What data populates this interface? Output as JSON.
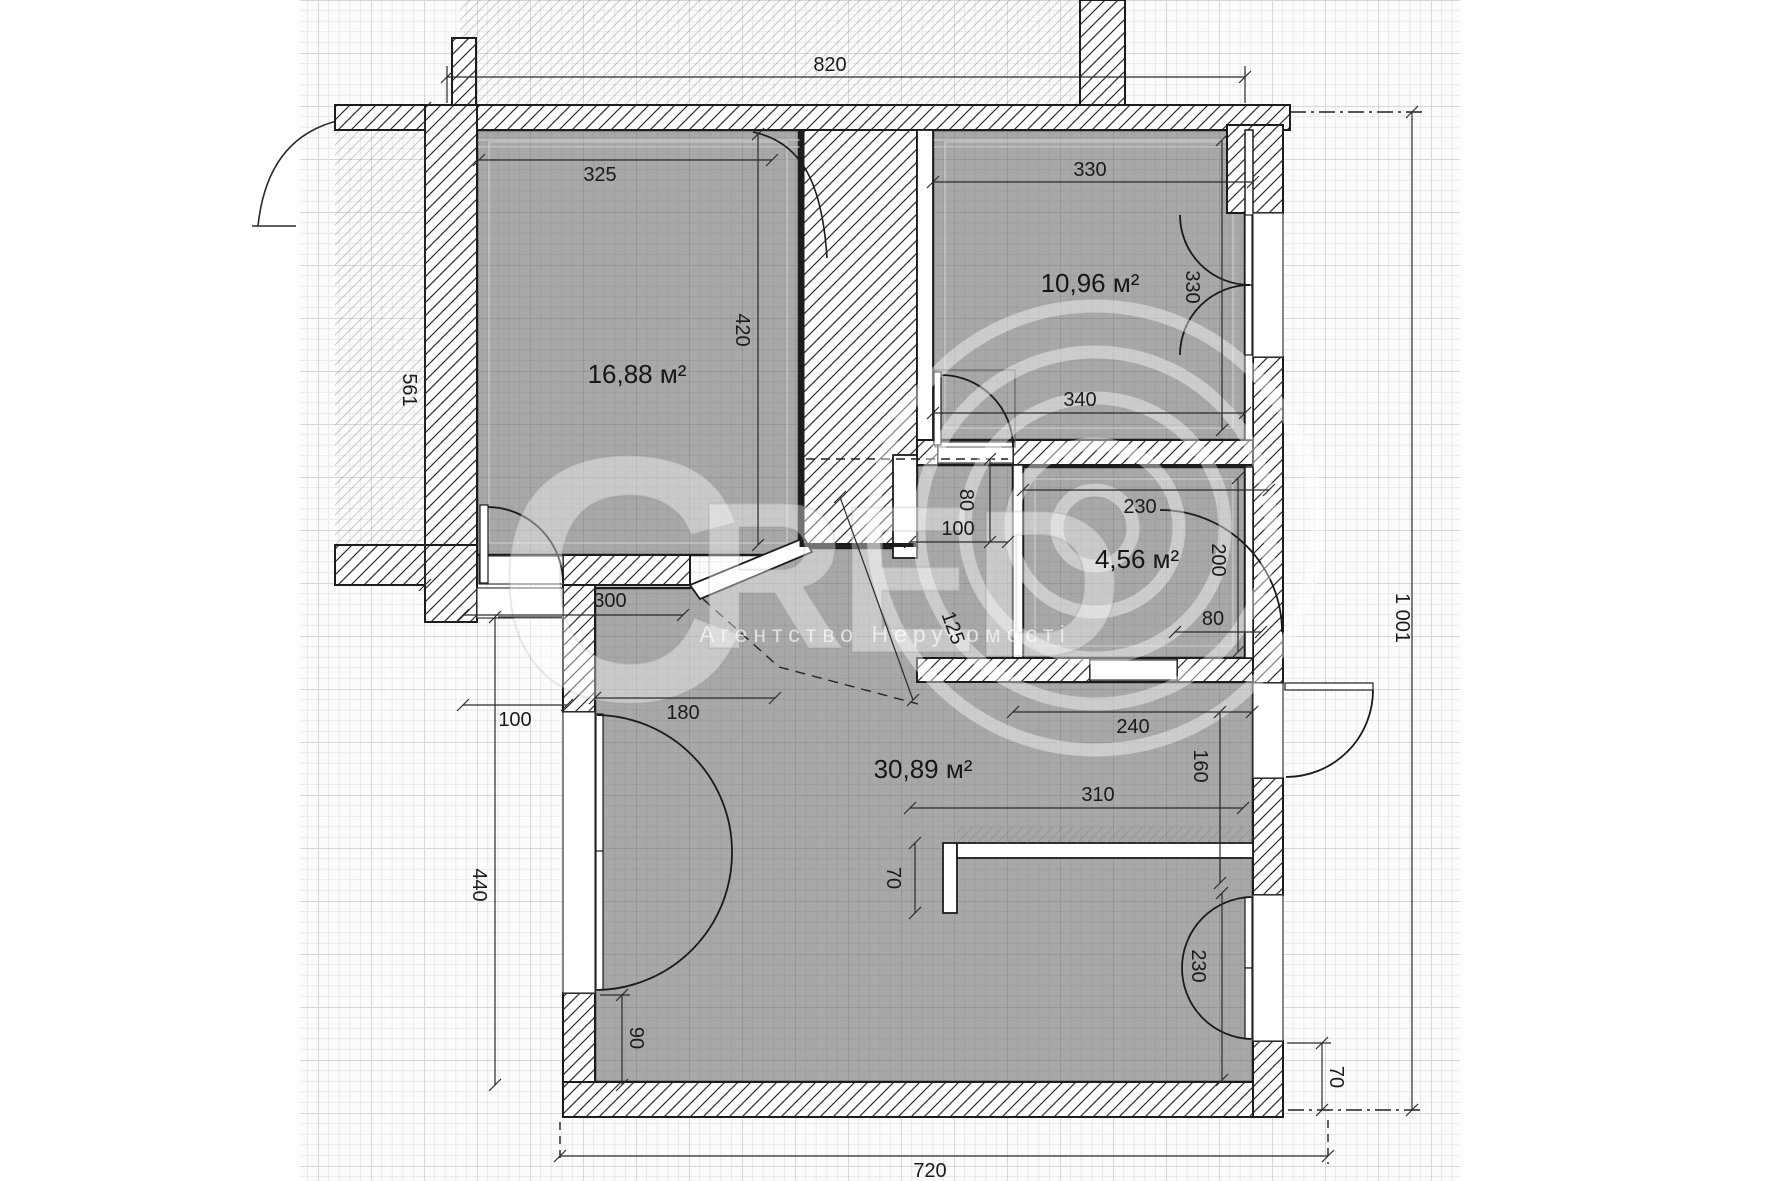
{
  "watermark": {
    "letters": [
      "C",
      "R",
      "E",
      "D"
    ],
    "subtitle": "Агентство Нерухомості"
  },
  "rooms": [
    {
      "id": "room-top-left",
      "area": "16,88 м²"
    },
    {
      "id": "room-top-right",
      "area": "10,96 м²"
    },
    {
      "id": "room-bathroom",
      "area": "4,56 м²"
    },
    {
      "id": "room-living",
      "area": "30,89 м²"
    }
  ],
  "dimensions": {
    "top_width": "820",
    "r1_top": "325",
    "r2_top": "330",
    "r2_door": "330",
    "r2_bottom": "340",
    "bath_top": "230",
    "bath_right": "200",
    "bath_door": "80",
    "hall_h": "80",
    "hall_w": "100",
    "r1_door": "300",
    "r1_right": "420",
    "left_height": "561",
    "angled_door": "125",
    "living_left": "180",
    "left_offset": "100",
    "hall_width": "240",
    "vest_h": "160",
    "niche_w": "310",
    "niche_step": "70",
    "left_lower": "440",
    "door_offset": "90",
    "balc_door": "230",
    "out_offset": "70",
    "bottom_width": "720",
    "right_height": "1 001"
  }
}
